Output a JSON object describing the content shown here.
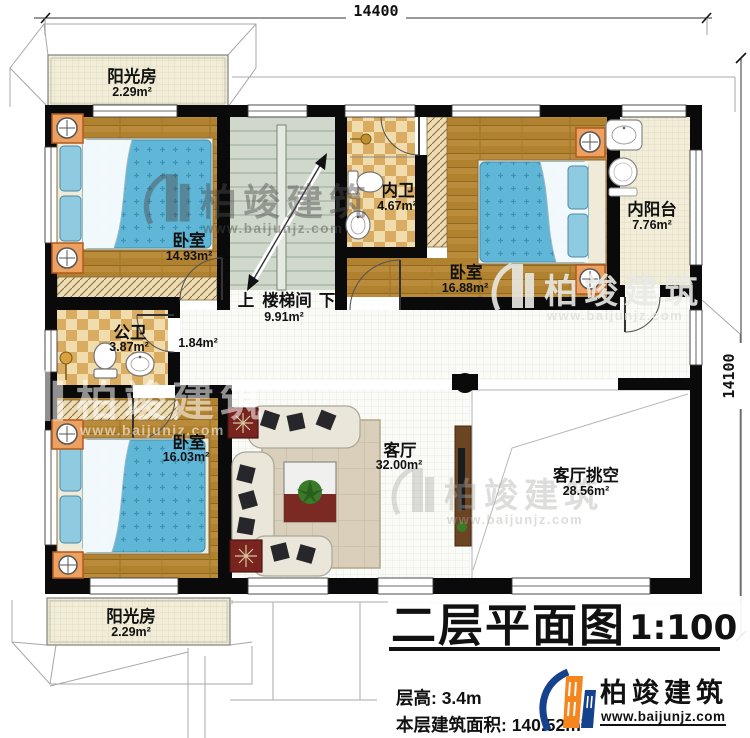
{
  "title": {
    "text": "二层平面图",
    "scale": "1:100"
  },
  "info": {
    "floor_height": "层高: 3.4m",
    "floor_area": "本层建筑面积: 140.52m²"
  },
  "brand": {
    "name": "柏竣建筑",
    "url": "www.baijunjz.com"
  },
  "watermark": {
    "text": "柏竣建筑",
    "url": "www.baijunjz.com"
  },
  "dimensions": {
    "top": "14400",
    "right": "14100"
  },
  "rooms": {
    "sunroom_top": {
      "name": "阳光房",
      "area": "2.29m²"
    },
    "bedroom_tl": {
      "name": "卧室",
      "area": "14.93m²"
    },
    "stairwell": {
      "name": "楼梯间",
      "area": "9.91m²",
      "up": "上",
      "down": "下"
    },
    "inner_bath": {
      "name": "内卫",
      "area": "4.67m²"
    },
    "bedroom_tr": {
      "name": "卧室",
      "area": "16.88m²"
    },
    "inner_balcony": {
      "name": "内阳台",
      "area": "7.76m²"
    },
    "public_bath": {
      "name": "公卫",
      "area": "3.87m²"
    },
    "hallway": {
      "area": "1.84m²"
    },
    "bedroom_bl": {
      "name": "卧室",
      "area": "16.03m²"
    },
    "living": {
      "name": "客厅",
      "area": "32.00m²"
    },
    "void": {
      "name": "客厅挑空",
      "area": "28.56m²"
    },
    "sunroom_bottom": {
      "name": "阳光房",
      "area": "2.29m²"
    }
  },
  "colors": {
    "wall": "#0a0a0a",
    "wood_floor": "#b0812f",
    "bed": "#5fb6d6",
    "tile": "#d9ac62",
    "cream": "#f2edd8",
    "stair": "#cfd8cb",
    "brand_blue": "#16418c",
    "brand_orange": "#f5861f"
  }
}
